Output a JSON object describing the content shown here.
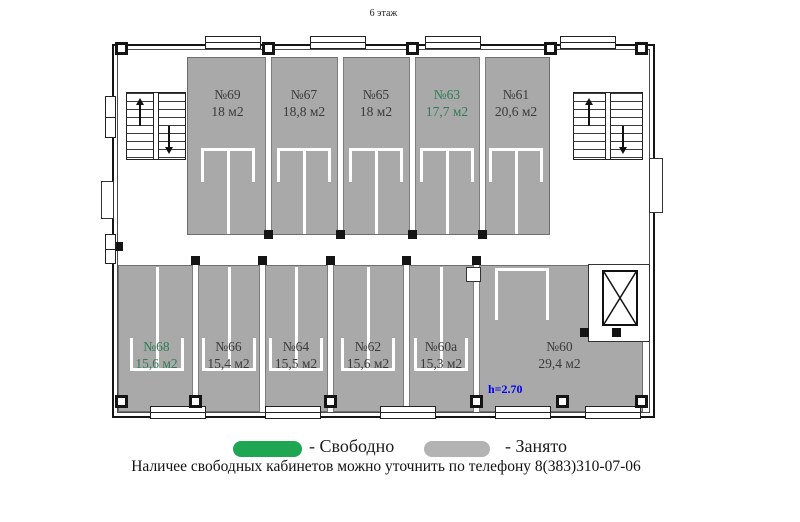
{
  "title": "6 этаж",
  "floor_plan": {
    "top_rooms": [
      {
        "number": "№69",
        "area": "18 м2",
        "status": "occupied"
      },
      {
        "number": "№67",
        "area": "18,8 м2",
        "status": "occupied"
      },
      {
        "number": "№65",
        "area": "18 м2",
        "status": "occupied"
      },
      {
        "number": "№63",
        "area": "17,7 м2",
        "status": "free"
      },
      {
        "number": "№61",
        "area": "20,6 м2",
        "status": "occupied"
      }
    ],
    "bottom_rooms": [
      {
        "number": "№68",
        "area": "15,6 м2",
        "status": "free"
      },
      {
        "number": "№66",
        "area": "15,4 м2",
        "status": "occupied"
      },
      {
        "number": "№64",
        "area": "15,5 м2",
        "status": "occupied"
      },
      {
        "number": "№62",
        "area": "15,6 м2",
        "status": "occupied"
      },
      {
        "number": "№60а",
        "area": "15,3 м2",
        "status": "occupied"
      },
      {
        "number": "№60",
        "area": "29,4 м2",
        "status": "occupied"
      }
    ],
    "ceiling_height_note": "h=2.70"
  },
  "legend": {
    "free_label": "- Свободно",
    "occupied_label": "- Занято",
    "free_color": "#1ea652",
    "occupied_color": "#b3b3b3"
  },
  "footer_note": "Наличее свободных кабинетов можно уточнить по телефону 8(383)310-07-06",
  "colors": {
    "room_fill": "#a9a9a9",
    "free_text": "#2f7c55",
    "occupied_text": "#3a3a3a",
    "height_note_color": "#0000ee"
  }
}
